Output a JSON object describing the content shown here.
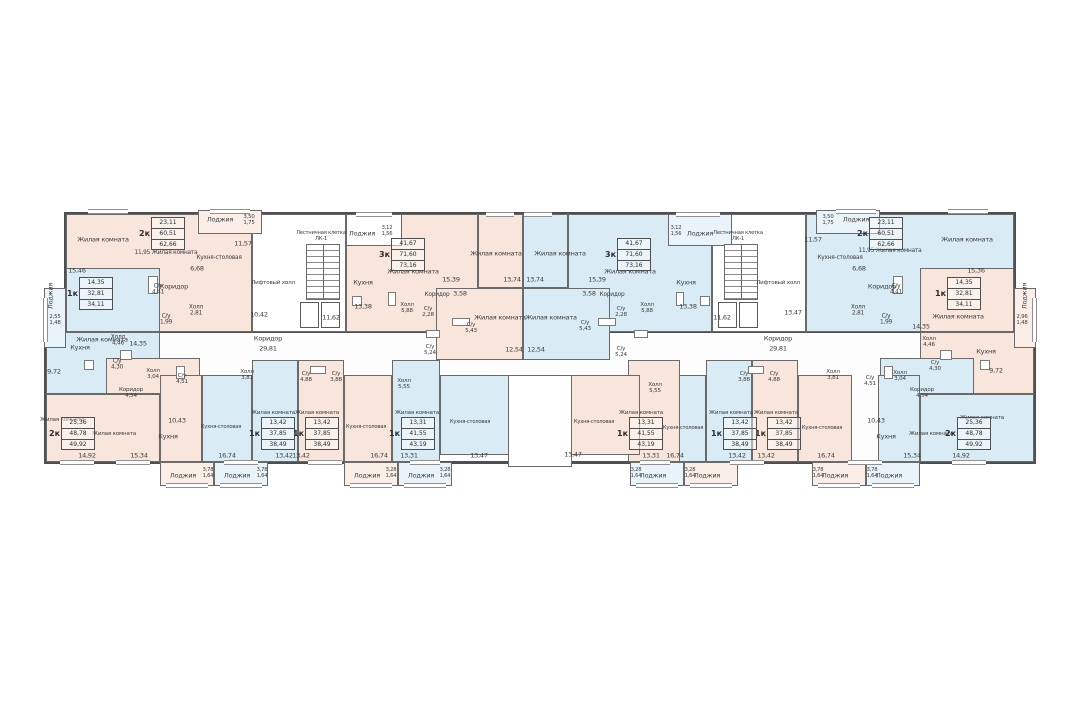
{
  "plan": {
    "kind": "residential floor plan",
    "stair_core_label": "Лестничная клетка\nЛК-1",
    "lift_hall_label": "Лифтовый холл",
    "corridor_label": "Коридор",
    "corridor_area": "29,81"
  },
  "colors": {
    "peach": "#f8e5db",
    "blue": "#d9ebf5",
    "peach_light": "#fbeee7",
    "blue_light": "#e8f3fa",
    "wall": "#5c5c5c",
    "text": "#3c3c3c"
  },
  "tables": [
    {
      "type": "2к",
      "rows": [
        "23,11",
        "60,51",
        "62,66"
      ],
      "x": 152,
      "y": 217
    },
    {
      "type": "1к",
      "rows": [
        "14,35",
        "32,81",
        "34,11"
      ],
      "x": 80,
      "y": 277
    },
    {
      "type": "3к",
      "rows": [
        "41,67",
        "71,60",
        "73,16"
      ],
      "x": 392,
      "y": 238
    },
    {
      "type": "2к",
      "rows": [
        "25,36",
        "48,78",
        "49,92"
      ],
      "x": 62,
      "y": 417
    },
    {
      "type": "1к",
      "rows": [
        "13,42",
        "37,85",
        "38,49"
      ],
      "x": 262,
      "y": 417
    },
    {
      "type": "1к",
      "rows": [
        "13,42",
        "37,85",
        "38,49"
      ],
      "x": 306,
      "y": 417
    },
    {
      "type": "1к",
      "rows": [
        "13,31",
        "41,55",
        "43,19"
      ],
      "x": 402,
      "y": 417
    },
    {
      "type": "2к",
      "rows": [
        "23,11",
        "60,51",
        "62,66"
      ],
      "x": 870,
      "y": 217
    },
    {
      "type": "1к",
      "rows": [
        "14,35",
        "32,81",
        "34,11"
      ],
      "x": 948,
      "y": 277
    },
    {
      "type": "3к",
      "rows": [
        "41,67",
        "71,60",
        "73,16"
      ],
      "x": 618,
      "y": 238
    },
    {
      "type": "2к",
      "rows": [
        "25,36",
        "48,78",
        "49,92"
      ],
      "x": 958,
      "y": 417
    },
    {
      "type": "1к",
      "rows": [
        "13,42",
        "37,85",
        "38,49"
      ],
      "x": 768,
      "y": 417
    },
    {
      "type": "1к",
      "rows": [
        "13,42",
        "37,85",
        "38,49"
      ],
      "x": 724,
      "y": 417
    },
    {
      "type": "1к",
      "rows": [
        "13,31",
        "41,55",
        "43,19"
      ],
      "x": 630,
      "y": 417
    }
  ],
  "labels": [
    {
      "t": "Жилая комната",
      "x": 103,
      "y": 240
    },
    {
      "t": "15,46",
      "x": 77,
      "y": 271
    },
    {
      "t": "11,95  Жилая комната",
      "x": 166,
      "y": 253,
      "s": 5.8
    },
    {
      "t": "Коридор",
      "x": 174,
      "y": 287
    },
    {
      "t": "6,68",
      "x": 197,
      "y": 269
    },
    {
      "t": "Кухня-столовая",
      "x": 219,
      "y": 258,
      "s": 5.8
    },
    {
      "t": "11,57",
      "x": 243,
      "y": 244
    },
    {
      "t": "Лоджия",
      "x": 220,
      "y": 220
    },
    {
      "t": "3,50\n1,75",
      "x": 249,
      "y": 220,
      "s": 5.4
    },
    {
      "t": "С/у\n4,41",
      "x": 158,
      "y": 290,
      "s": 5.8
    },
    {
      "t": "Холл\n2,81",
      "x": 196,
      "y": 311,
      "s": 5.8
    },
    {
      "t": "С/у\n1,99",
      "x": 166,
      "y": 320,
      "s": 5.8
    },
    {
      "t": "Жилая комната",
      "x": 102,
      "y": 340
    },
    {
      "t": "14,35",
      "x": 138,
      "y": 344
    },
    {
      "t": "Лоджия",
      "x": 51,
      "y": 296,
      "v": 1
    },
    {
      "t": "2,55\n1,48",
      "x": 55,
      "y": 320,
      "s": 5.4
    },
    {
      "t": "Кухня",
      "x": 80,
      "y": 348
    },
    {
      "t": "9,72",
      "x": 54,
      "y": 372
    },
    {
      "t": "Холл\n4,46",
      "x": 118,
      "y": 341,
      "s": 5.8
    },
    {
      "t": "С/у\n4,30",
      "x": 117,
      "y": 365,
      "s": 5.8
    },
    {
      "t": "Жилая комната",
      "x": 62,
      "y": 420,
      "s": 5.6
    },
    {
      "t": "14,92",
      "x": 87,
      "y": 456
    },
    {
      "t": "Жилая комната",
      "x": 114,
      "y": 434,
      "s": 5.6
    },
    {
      "t": "15,34",
      "x": 139,
      "y": 456
    },
    {
      "t": "Коридор\n4,54",
      "x": 131,
      "y": 393,
      "s": 5.6
    },
    {
      "t": "Холл\n3,04",
      "x": 153,
      "y": 374,
      "s": 5.6
    },
    {
      "t": "С/у\n4,51",
      "x": 182,
      "y": 379,
      "s": 5.6
    },
    {
      "t": "10,43",
      "x": 177,
      "y": 421
    },
    {
      "t": "Кухня",
      "x": 168,
      "y": 437
    },
    {
      "t": "Кухня-столовая",
      "x": 221,
      "y": 428,
      "s": 5.2
    },
    {
      "t": "16,74",
      "x": 227,
      "y": 456
    },
    {
      "t": "Жилая комната",
      "x": 273,
      "y": 413,
      "s": 5.6
    },
    {
      "t": "13,42",
      "x": 284,
      "y": 456
    },
    {
      "t": "Холл\n3,81",
      "x": 247,
      "y": 375,
      "s": 5.6
    },
    {
      "t": "С/у\n4,88",
      "x": 306,
      "y": 377,
      "s": 5.6
    },
    {
      "t": "С/у\n3,88",
      "x": 336,
      "y": 377,
      "s": 5.6
    },
    {
      "t": "Жилая комната",
      "x": 317,
      "y": 413,
      "s": 5.6
    },
    {
      "t": "13,42",
      "x": 301,
      "y": 456
    },
    {
      "t": "Кухня-столовая",
      "x": 366,
      "y": 428,
      "s": 5.2
    },
    {
      "t": "16,74",
      "x": 379,
      "y": 456
    },
    {
      "t": "Холл\n5,55",
      "x": 404,
      "y": 384,
      "s": 5.6
    },
    {
      "t": "Жилая комната",
      "x": 417,
      "y": 413,
      "s": 5.6
    },
    {
      "t": "13,31",
      "x": 409,
      "y": 456
    },
    {
      "t": "Кухня-столовая",
      "x": 470,
      "y": 423,
      "s": 5.2
    },
    {
      "t": "13,47",
      "x": 479,
      "y": 456
    },
    {
      "t": "С/у\n5,24",
      "x": 430,
      "y": 350,
      "s": 5.6
    },
    {
      "t": "Лоджия",
      "x": 183,
      "y": 476
    },
    {
      "t": "3,78\n1,64",
      "x": 208,
      "y": 474,
      "s": 5.2
    },
    {
      "t": "Лоджия",
      "x": 237,
      "y": 476
    },
    {
      "t": "3,78\n1,64",
      "x": 262,
      "y": 474,
      "s": 5.2
    },
    {
      "t": "Лоджия",
      "x": 367,
      "y": 476
    },
    {
      "t": "3,28\n1,64",
      "x": 391,
      "y": 474,
      "s": 5.2
    },
    {
      "t": "Лоджия",
      "x": 421,
      "y": 476
    },
    {
      "t": "3,28\n1,64",
      "x": 445,
      "y": 474,
      "s": 5.2
    },
    {
      "t": "Жилая комната",
      "x": 413,
      "y": 272
    },
    {
      "t": "15,39",
      "x": 451,
      "y": 280
    },
    {
      "t": "Кухня",
      "x": 363,
      "y": 283
    },
    {
      "t": "13,38",
      "x": 363,
      "y": 307
    },
    {
      "t": "Холл\n5,88",
      "x": 407,
      "y": 308,
      "s": 5.6
    },
    {
      "t": "Коридор",
      "x": 437,
      "y": 295,
      "s": 5.8
    },
    {
      "t": "3,58",
      "x": 460,
      "y": 294
    },
    {
      "t": "С/у\n2,28",
      "x": 428,
      "y": 312,
      "s": 5.6
    },
    {
      "t": "С/у\n5,43",
      "x": 471,
      "y": 328,
      "s": 5.6
    },
    {
      "t": "Жилая комната",
      "x": 496,
      "y": 254
    },
    {
      "t": "13,74",
      "x": 512,
      "y": 280
    },
    {
      "t": "Жилая комната",
      "x": 500,
      "y": 318
    },
    {
      "t": "12,54",
      "x": 514,
      "y": 350
    },
    {
      "t": "Лоджия",
      "x": 362,
      "y": 234
    },
    {
      "t": "3,12\n1,56",
      "x": 387,
      "y": 232,
      "s": 5.2
    },
    {
      "t": "Лестничная клетка\nЛК-1",
      "x": 321,
      "y": 237,
      "s": 5.2
    },
    {
      "t": "11,62",
      "x": 331,
      "y": 318
    },
    {
      "t": "Лифтовый холл",
      "x": 273,
      "y": 283,
      "s": 5.6
    },
    {
      "t": "10,42",
      "x": 259,
      "y": 315
    },
    {
      "t": "Лестничная клетка\nЛК-1",
      "x": 738,
      "y": 237,
      "s": 5.2
    },
    {
      "t": "11,62",
      "x": 722,
      "y": 318
    },
    {
      "t": "Лифтовый холл",
      "x": 778,
      "y": 283,
      "s": 5.6
    },
    {
      "t": "13,47",
      "x": 793,
      "y": 313
    },
    {
      "t": "Коридор",
      "x": 268,
      "y": 339
    },
    {
      "t": "29,81",
      "x": 268,
      "y": 349
    },
    {
      "t": "Коридор",
      "x": 778,
      "y": 339
    },
    {
      "t": "29,81",
      "x": 778,
      "y": 349
    },
    {
      "t": "Жилая комната",
      "x": 630,
      "y": 272
    },
    {
      "t": "15,39",
      "x": 597,
      "y": 280
    },
    {
      "t": "Кухня",
      "x": 686,
      "y": 283
    },
    {
      "t": "13,38",
      "x": 688,
      "y": 307
    },
    {
      "t": "Холл\n5,88",
      "x": 647,
      "y": 308,
      "s": 5.6
    },
    {
      "t": "Коридор",
      "x": 612,
      "y": 295,
      "s": 5.8
    },
    {
      "t": "3,58",
      "x": 589,
      "y": 294
    },
    {
      "t": "С/у\n2,28",
      "x": 621,
      "y": 312,
      "s": 5.6
    },
    {
      "t": "С/у\n5,43",
      "x": 585,
      "y": 326,
      "s": 5.6
    },
    {
      "t": "Жилая комната",
      "x": 560,
      "y": 254
    },
    {
      "t": "13,74",
      "x": 535,
      "y": 280
    },
    {
      "t": "Жилая комната",
      "x": 551,
      "y": 318
    },
    {
      "t": "12,54",
      "x": 536,
      "y": 350
    },
    {
      "t": "Лоджия",
      "x": 700,
      "y": 234
    },
    {
      "t": "3,12\n1,56",
      "x": 676,
      "y": 232,
      "s": 5.2
    },
    {
      "t": "С/у\n5,24",
      "x": 621,
      "y": 352,
      "s": 5.6
    },
    {
      "t": "Кухня-столовая",
      "x": 594,
      "y": 423,
      "s": 5.2
    },
    {
      "t": "13,47",
      "x": 573,
      "y": 455
    },
    {
      "t": "Холл\n5,55",
      "x": 655,
      "y": 388,
      "s": 5.6
    },
    {
      "t": "Жилая комната",
      "x": 641,
      "y": 413,
      "s": 5.6
    },
    {
      "t": "13,31",
      "x": 651,
      "y": 456
    },
    {
      "t": "Кухня-столовая",
      "x": 683,
      "y": 429,
      "s": 5.2
    },
    {
      "t": "16,74",
      "x": 675,
      "y": 456
    },
    {
      "t": "Жилая комната",
      "x": 731,
      "y": 413,
      "s": 5.6
    },
    {
      "t": "13,42",
      "x": 737,
      "y": 456
    },
    {
      "t": "С/у\n3,88",
      "x": 744,
      "y": 377,
      "s": 5.6
    },
    {
      "t": "С/у\n4,88",
      "x": 774,
      "y": 377,
      "s": 5.6
    },
    {
      "t": "Холл\n3,81",
      "x": 833,
      "y": 375,
      "s": 5.6
    },
    {
      "t": "Жилая комната",
      "x": 776,
      "y": 413,
      "s": 5.6
    },
    {
      "t": "13,42",
      "x": 766,
      "y": 456
    },
    {
      "t": "Кухня-столовая",
      "x": 822,
      "y": 429,
      "s": 5.2
    },
    {
      "t": "16,74",
      "x": 826,
      "y": 456
    },
    {
      "t": "Кухня",
      "x": 886,
      "y": 437
    },
    {
      "t": "10,43",
      "x": 876,
      "y": 421
    },
    {
      "t": "Коридор\n4,54",
      "x": 922,
      "y": 393,
      "s": 5.6
    },
    {
      "t": "Холл\n3,04",
      "x": 900,
      "y": 376,
      "s": 5.6
    },
    {
      "t": "С/у\n4,51",
      "x": 870,
      "y": 381,
      "s": 5.6
    },
    {
      "t": "Жилая комната",
      "x": 931,
      "y": 434,
      "s": 5.6
    },
    {
      "t": "15,34",
      "x": 912,
      "y": 456
    },
    {
      "t": "Жилая комната",
      "x": 982,
      "y": 418,
      "s": 5.6
    },
    {
      "t": "14,92",
      "x": 961,
      "y": 456
    },
    {
      "t": "Жилая комната",
      "x": 958,
      "y": 317
    },
    {
      "t": "14,35",
      "x": 921,
      "y": 327
    },
    {
      "t": "Лоджия",
      "x": 1025,
      "y": 296,
      "v": 1
    },
    {
      "t": "2,96\n1,48",
      "x": 1022,
      "y": 320,
      "s": 5.4
    },
    {
      "t": "Кухня",
      "x": 986,
      "y": 352
    },
    {
      "t": "9,72",
      "x": 996,
      "y": 371
    },
    {
      "t": "Холл\n4,46",
      "x": 929,
      "y": 342,
      "s": 5.6
    },
    {
      "t": "С/у\n4,30",
      "x": 935,
      "y": 366,
      "s": 5.6
    },
    {
      "t": "Жилая комната",
      "x": 967,
      "y": 240
    },
    {
      "t": "15,36",
      "x": 976,
      "y": 271
    },
    {
      "t": "11,95  Жилая комната",
      "x": 890,
      "y": 251,
      "s": 5.8
    },
    {
      "t": "Коридор",
      "x": 882,
      "y": 287
    },
    {
      "t": "6,68",
      "x": 859,
      "y": 269
    },
    {
      "t": "Кухня-столовая",
      "x": 840,
      "y": 258,
      "s": 5.8
    },
    {
      "t": "11,57",
      "x": 813,
      "y": 240
    },
    {
      "t": "Лоджия",
      "x": 856,
      "y": 220
    },
    {
      "t": "3,50\n1,75",
      "x": 828,
      "y": 220,
      "s": 5.4
    },
    {
      "t": "С/у\n4,41",
      "x": 896,
      "y": 290,
      "s": 5.8
    },
    {
      "t": "Холл\n2,81",
      "x": 858,
      "y": 311,
      "s": 5.8
    },
    {
      "t": "С/у\n1,99",
      "x": 886,
      "y": 320,
      "s": 5.8
    },
    {
      "t": "Лоджия",
      "x": 653,
      "y": 476
    },
    {
      "t": "3,28\n1,64",
      "x": 636,
      "y": 474,
      "s": 5.2
    },
    {
      "t": "Лоджия",
      "x": 707,
      "y": 476
    },
    {
      "t": "3,28\n1,64",
      "x": 690,
      "y": 474,
      "s": 5.2
    },
    {
      "t": "Лоджия",
      "x": 835,
      "y": 476
    },
    {
      "t": "3,78\n1,64",
      "x": 818,
      "y": 474,
      "s": 5.2
    },
    {
      "t": "Лоджия",
      "x": 889,
      "y": 476
    },
    {
      "t": "3,78\n1,64",
      "x": 872,
      "y": 474,
      "s": 5.2
    }
  ]
}
